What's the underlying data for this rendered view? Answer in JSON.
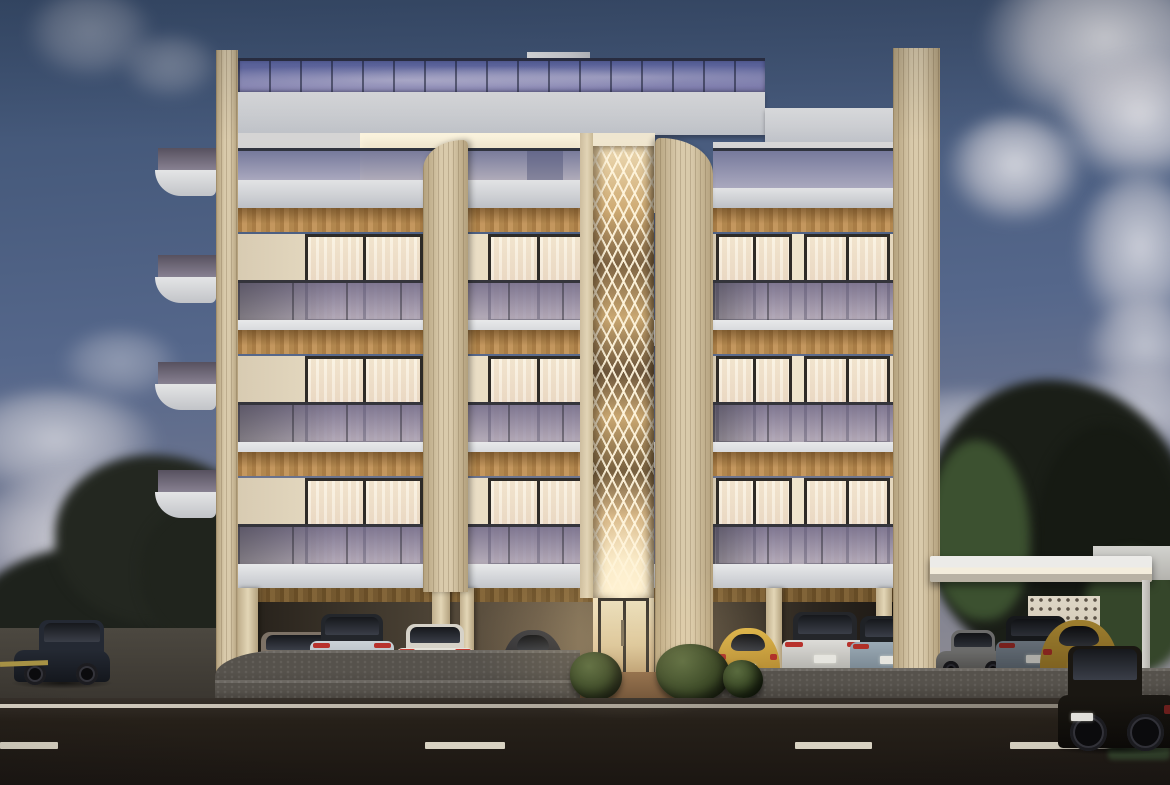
{
  "scene": {
    "type": "architectural-render",
    "time_of_day": "dusk",
    "subject": "modern five-storey apartment building, rooftop glass terrace, lit central diamond-lattice feature, pilotis parking with cars, street in foreground"
  },
  "palette": {
    "sky_top": "#3b5070",
    "sky_mid": "#55678b",
    "sky_low": "#767a90",
    "sky_horizon": "#8f8d93",
    "cream": "#d9caab",
    "cream_d": "#b3a07c",
    "roof_glass1": "#5c66a4",
    "roof_glass2": "#8d89ba",
    "win_frame": "#2e2b27",
    "lattice_line": "rgba(255,245,221,0.92)"
  },
  "clouds": [
    {
      "x": 980,
      "y": -40,
      "w": 250,
      "h": 170,
      "op": 0.95
    },
    {
      "x": 1055,
      "y": 55,
      "w": 170,
      "h": 130,
      "op": 0.9
    },
    {
      "x": 945,
      "y": 115,
      "w": 140,
      "h": 110,
      "op": 0.85
    },
    {
      "x": 1075,
      "y": 175,
      "w": 130,
      "h": 160,
      "op": 0.8
    },
    {
      "x": 1085,
      "y": 300,
      "w": 120,
      "h": 100,
      "op": 0.7
    },
    {
      "x": 1040,
      "y": 370,
      "w": 200,
      "h": 90,
      "op": 0.65
    },
    {
      "x": 860,
      "y": 390,
      "w": 220,
      "h": 80,
      "op": 0.55
    },
    {
      "x": -50,
      "y": 390,
      "w": 210,
      "h": 110,
      "op": 0.7
    },
    {
      "x": -40,
      "y": 470,
      "w": 270,
      "h": 150,
      "op": 0.85
    },
    {
      "x": 90,
      "y": 545,
      "w": 230,
      "h": 110,
      "op": 0.8
    },
    {
      "x": 25,
      "y": -10,
      "w": 130,
      "h": 90,
      "op": 0.4
    },
    {
      "x": 120,
      "y": 35,
      "w": 100,
      "h": 65,
      "op": 0.35
    },
    {
      "x": 235,
      "y": 385,
      "w": 100,
      "h": 55,
      "op": 0.45
    },
    {
      "x": 60,
      "y": 330,
      "w": 120,
      "h": 70,
      "op": 0.4
    }
  ],
  "trees": [
    {
      "x": -25,
      "y": 545,
      "w": 280,
      "h": 150,
      "c": "#1e221c"
    },
    {
      "x": 55,
      "y": 455,
      "w": 210,
      "h": 170,
      "c": "#232720"
    },
    {
      "x": 140,
      "y": 500,
      "w": 160,
      "h": 150,
      "c": "#20241d"
    },
    {
      "x": 925,
      "y": 380,
      "w": 270,
      "h": 290,
      "c": "#1a1e17"
    },
    {
      "x": 1035,
      "y": 425,
      "w": 150,
      "h": 250,
      "c": "#161a13"
    },
    {
      "x": 930,
      "y": 440,
      "w": 100,
      "h": 180,
      "c": "#3c5130"
    },
    {
      "x": 1085,
      "y": 550,
      "w": 100,
      "h": 120,
      "c": "#35462a"
    }
  ],
  "building": {
    "storeys": 5,
    "floor_metrics": {
      "soffit_h": 24,
      "window_dy": 26,
      "window_h": 88,
      "balc_dy": 72,
      "balc_h": 42,
      "slab_dy": 112,
      "slab_h": 26
    },
    "floors": [
      {
        "top": 208
      },
      {
        "top": 330
      },
      {
        "top": 452
      }
    ],
    "wings": [
      {
        "name": "left",
        "x": 238,
        "w": 345,
        "slab_x": 226,
        "slab_w": 367,
        "windows": [
          {
            "x": 305,
            "w": 118
          },
          {
            "x": 488,
            "w": 100
          }
        ]
      },
      {
        "name": "right",
        "x": 713,
        "w": 180,
        "slab_x": 653,
        "slab_w": 248,
        "windows": [
          {
            "x": 716,
            "w": 76
          },
          {
            "x": 804,
            "w": 86
          }
        ]
      }
    ],
    "side_balconies": [
      {
        "y": 148
      },
      {
        "y": 255
      },
      {
        "y": 362
      },
      {
        "y": 470
      }
    ],
    "ground_columns": [
      {
        "x": 238,
        "w": 20
      },
      {
        "x": 432,
        "w": 18
      },
      {
        "x": 460,
        "w": 14
      },
      {
        "x": 766,
        "w": 16
      },
      {
        "x": 876,
        "w": 16
      }
    ]
  },
  "bushes": [
    {
      "x": 570,
      "y": 652,
      "w": 52,
      "h": 48
    },
    {
      "x": 656,
      "y": 644,
      "w": 74,
      "h": 58
    },
    {
      "x": 723,
      "y": 660,
      "w": 40,
      "h": 38
    }
  ],
  "cars": [
    {
      "name": "suv-street-left",
      "kind": "suv_side",
      "x": 14,
      "y": 620,
      "w": 96,
      "h": 62,
      "body": "#242933",
      "body2": "#14171d",
      "tail": "#7a2a28"
    },
    {
      "name": "coupe-grey",
      "kind": "rear",
      "x": 248,
      "y": 632,
      "w": 98,
      "h": 52,
      "body": "#998e80",
      "body2": "#6f6458",
      "roof": "#7d7266",
      "tail": "#c03c30"
    },
    {
      "name": "evoque-white-1",
      "kind": "suv_rear",
      "x": 310,
      "y": 614,
      "w": 84,
      "h": 64,
      "body": "#ccd3d8",
      "body2": "#9aa2a8",
      "roof": "#23262b",
      "tail": "#b8322c"
    },
    {
      "name": "coupe-white",
      "kind": "rear",
      "x": 396,
      "y": 624,
      "w": 78,
      "h": 56,
      "body": "#e7e4dc",
      "body2": "#b6b2a8",
      "roof": "#d6d2c8",
      "tail": "#c23a30"
    },
    {
      "name": "beetle-dark",
      "kind": "beetle",
      "x": 502,
      "y": 630,
      "w": 62,
      "h": 54,
      "body": "#3b3b3f",
      "body2": "#202024",
      "tail": "#8c2e28"
    },
    {
      "name": "beetle-yellow-1",
      "kind": "beetle",
      "x": 716,
      "y": 628,
      "w": 64,
      "h": 57,
      "body": "#dcb347",
      "body2": "#a97f2c",
      "tail": "#b03028"
    },
    {
      "name": "evoque-white-2",
      "kind": "suv_rear",
      "x": 782,
      "y": 612,
      "w": 86,
      "h": 66,
      "body": "#dddcd8",
      "body2": "#a8a7a2",
      "roof": "#24262a",
      "tail": "#b8322c"
    },
    {
      "name": "evoque-blue",
      "kind": "suv_rear",
      "x": 850,
      "y": 616,
      "w": 80,
      "h": 62,
      "body": "#9cabb6",
      "body2": "#6f7d88",
      "roof": "#1f2226",
      "tail": "#b03028"
    },
    {
      "name": "sedan-silver",
      "kind": "sedan_side",
      "x": 936,
      "y": 630,
      "w": 74,
      "h": 44,
      "body": "#8f8f8d",
      "body2": "#63625f",
      "tail": "#7a2a26"
    },
    {
      "name": "evoque-carport",
      "kind": "suv_rear",
      "x": 996,
      "y": 616,
      "w": 80,
      "h": 60,
      "body": "#87939f",
      "body2": "#5c6670",
      "roof": "#1d2024",
      "tail": "#a02c26"
    },
    {
      "name": "beetle-yellow-2",
      "kind": "beetle",
      "x": 1040,
      "y": 620,
      "w": 78,
      "h": 64,
      "body": "#d2a93e",
      "body2": "#9b7626",
      "tail": "#b03028"
    },
    {
      "name": "mini-street-right",
      "kind": "mini",
      "x": 1058,
      "y": 646,
      "w": 120,
      "h": 102,
      "body": "#1a1712",
      "body2": "#0c0a07",
      "tail": "#6e1f1c"
    }
  ],
  "road": {
    "dash_y": 742,
    "dash_h": 7,
    "dashes": [
      {
        "x": 0,
        "w": 58
      },
      {
        "x": 425,
        "w": 80
      },
      {
        "x": 795,
        "w": 77
      },
      {
        "x": 1010,
        "w": 118
      }
    ],
    "solid_line_y": 704,
    "yellow_mark": {
      "x": 0,
      "y": 661,
      "w": 48,
      "h": 5
    }
  }
}
